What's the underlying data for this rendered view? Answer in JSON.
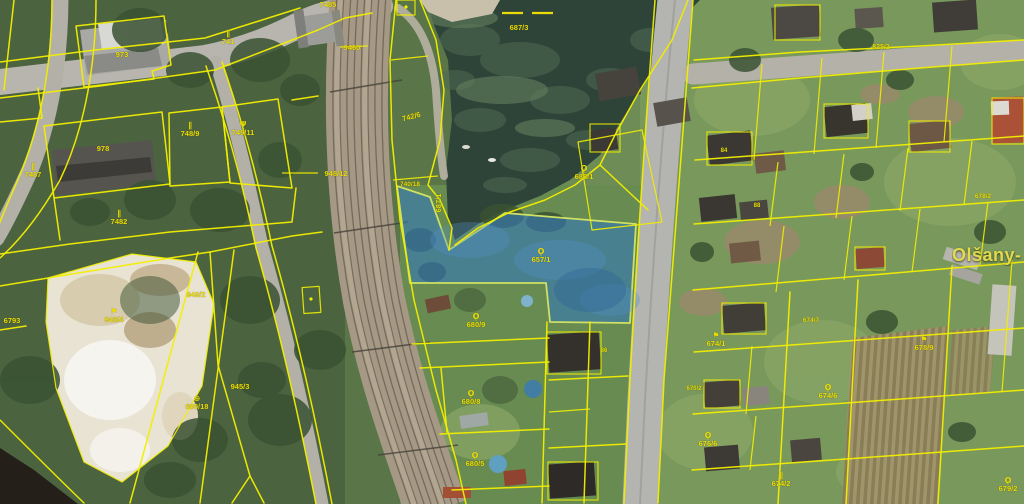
{
  "map": {
    "town_label": "Olšany-",
    "highlight_parcel": {
      "number": "657/1",
      "fill": "#3579b8",
      "fill_opacity": 0.62,
      "border": "#cfe163"
    },
    "colors": {
      "parcel_line": "#f2ee00",
      "label_text": "#e9dc05",
      "water": "#2f4438",
      "railway_bed": "#a59884",
      "road": "#b4b1a9",
      "quarry_sand": "#e9e3d4",
      "forest": "#4c6340",
      "grass_east": "#79985c"
    },
    "symbols": {
      "meadow": "∥",
      "garden": "Ǫ",
      "tree": "Ψ",
      "flag": "⚑",
      "cross": "⊕"
    },
    "labels": [
      {
        "t": "973",
        "x": 122,
        "y": 57
      },
      {
        "t": "741",
        "x": 228,
        "y": 44,
        "sym": "meadow"
      },
      {
        "t": "978",
        "x": 103,
        "y": 151
      },
      {
        "t": "7487",
        "x": 33,
        "y": 177,
        "sym": "meadow"
      },
      {
        "t": "748/9",
        "x": 190,
        "y": 136,
        "sym": "meadow"
      },
      {
        "t": "749/11",
        "x": 243,
        "y": 135,
        "sym": "tree"
      },
      {
        "t": "7482",
        "x": 119,
        "y": 224,
        "sym": "meadow"
      },
      {
        "t": "7485",
        "x": 328,
        "y": 7
      },
      {
        "t": "6793",
        "x": 12,
        "y": 323
      },
      {
        "t": "949/2",
        "x": 196,
        "y": 297
      },
      {
        "t": "948/4",
        "x": 114,
        "y": 322,
        "sym": "flag"
      },
      {
        "t": "945/3",
        "x": 240,
        "y": 389
      },
      {
        "t": "680/18",
        "x": 197,
        "y": 409,
        "sym": "cross"
      },
      {
        "t": "9460",
        "x": 352,
        "y": 50
      },
      {
        "t": "948/12",
        "x": 336,
        "y": 176
      },
      {
        "t": "742/6",
        "x": 412,
        "y": 119,
        "rot": -15
      },
      {
        "t": "740/18",
        "x": 410,
        "y": 186,
        "fs": 6.5
      },
      {
        "t": "687/1",
        "x": 441,
        "y": 203,
        "rot": -90
      },
      {
        "t": "687/3",
        "x": 519,
        "y": 30
      },
      {
        "t": "688/1",
        "x": 584,
        "y": 179,
        "sym": "garden"
      },
      {
        "t": "657/1",
        "x": 541,
        "y": 262,
        "sym": "garden"
      },
      {
        "t": "680/9",
        "x": 476,
        "y": 327,
        "sym": "garden"
      },
      {
        "t": "680/8",
        "x": 471,
        "y": 404,
        "sym": "garden"
      },
      {
        "t": "680/5",
        "x": 475,
        "y": 466,
        "sym": "garden"
      },
      {
        "t": "825/2",
        "x": 881,
        "y": 49,
        "fs": 7
      },
      {
        "t": "674/1",
        "x": 716,
        "y": 346,
        "sym": "flag"
      },
      {
        "t": "674/6",
        "x": 828,
        "y": 398,
        "sym": "garden"
      },
      {
        "t": "676/6",
        "x": 708,
        "y": 446,
        "sym": "garden"
      },
      {
        "t": "674/2",
        "x": 781,
        "y": 486,
        "sym": "meadow"
      },
      {
        "t": "678/9",
        "x": 924,
        "y": 350,
        "sym": "flag"
      },
      {
        "t": "679/2",
        "x": 1008,
        "y": 491,
        "sym": "garden"
      },
      {
        "t": "674/7",
        "x": 811,
        "y": 322,
        "fs": 6.5
      },
      {
        "t": "678/2",
        "x": 983,
        "y": 198,
        "fs": 6.5
      },
      {
        "t": "670/2",
        "x": 694,
        "y": 390,
        "fs": 6
      },
      {
        "t": "84",
        "x": 724,
        "y": 152,
        "fs": 6
      },
      {
        "t": "88",
        "x": 757,
        "y": 207,
        "fs": 6
      },
      {
        "t": "86",
        "x": 604,
        "y": 352,
        "fs": 6
      }
    ]
  }
}
